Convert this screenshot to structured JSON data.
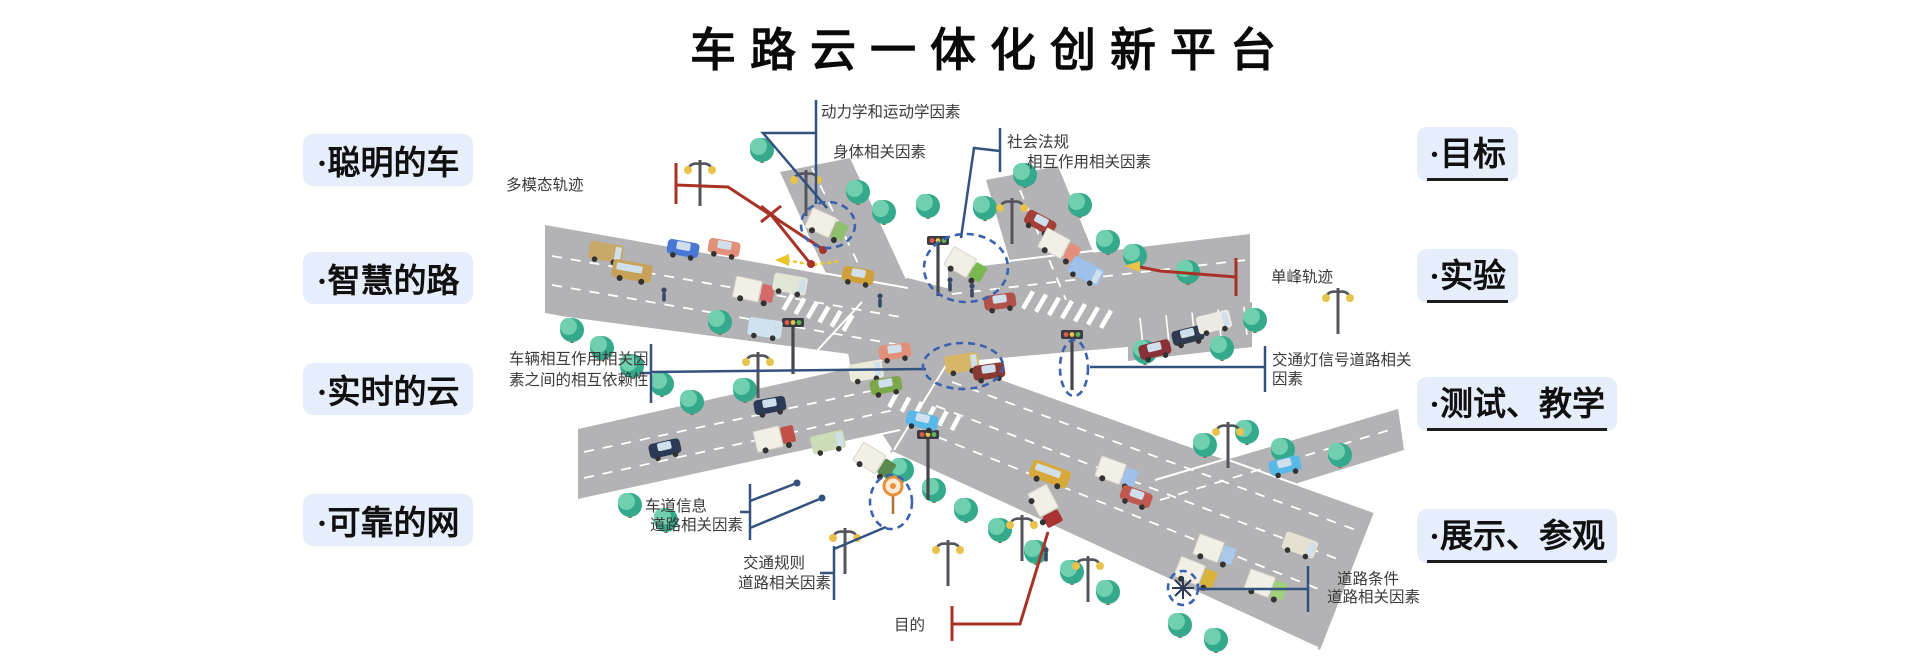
{
  "title": {
    "text": "车路云一体化创新平台"
  },
  "left_labels": [
    {
      "text": "·聪明的车"
    },
    {
      "text": "·智慧的路"
    },
    {
      "text": "·实时的云"
    },
    {
      "text": "·可靠的网"
    }
  ],
  "right_labels": [
    {
      "text": "·目标"
    },
    {
      "text": "·实验"
    },
    {
      "text": "·测试、教学"
    },
    {
      "text": "·展示、参观"
    }
  ],
  "callouts": {
    "dynamics": "动力学和运动学因素",
    "body_factor": "身体相关因素",
    "social_1": "社会法规",
    "social_2": "相互作用相关因素",
    "multimodal": "多模态轨迹",
    "interaction_1": "车辆相互作用相关因",
    "interaction_2": "素之间的相互依赖性",
    "lane_1": "车道信息",
    "lane_2": "道路相关因素",
    "rules_1": "交通规则",
    "rules_2": "道路相关因素",
    "purpose": "目的",
    "unimodal": "单峰轨迹",
    "signal_1": "交通灯信号道路相关",
    "signal_2": "因素",
    "condition_1": "道路条件",
    "condition_2": "道路相关因素"
  },
  "colors": {
    "label_bg": "#e6eefb",
    "callout_blue": "#33527f",
    "callout_red": "#a93226",
    "road": "#b3b2b4",
    "tree_dark": "#35a98c",
    "tree_light": "#6fcfae",
    "trunk": "#8a6a4a",
    "lamp_yellow": "#e8c24a",
    "highlight_dash": "#3a62b0",
    "pole": "#54545c",
    "window": "#cfe0ec",
    "truck_box": "#f2efe6"
  },
  "scene": {
    "trees": [
      [
        762,
        150
      ],
      [
        858,
        192
      ],
      [
        884,
        212
      ],
      [
        928,
        206
      ],
      [
        985,
        208
      ],
      [
        1025,
        175
      ],
      [
        1080,
        205
      ],
      [
        1108,
        242
      ],
      [
        1135,
        256
      ],
      [
        1188,
        272
      ],
      [
        1255,
        320
      ],
      [
        1222,
        348
      ],
      [
        1145,
        352
      ],
      [
        572,
        330
      ],
      [
        602,
        348
      ],
      [
        632,
        366
      ],
      [
        662,
        384
      ],
      [
        692,
        402
      ],
      [
        720,
        322
      ],
      [
        745,
        390
      ],
      [
        630,
        505
      ],
      [
        666,
        520
      ],
      [
        902,
        470
      ],
      [
        934,
        490
      ],
      [
        966,
        510
      ],
      [
        1000,
        530
      ],
      [
        1036,
        552
      ],
      [
        1072,
        572
      ],
      [
        1108,
        592
      ],
      [
        1205,
        445
      ],
      [
        1247,
        432
      ],
      [
        1283,
        450
      ],
      [
        1340,
        455
      ],
      [
        1180,
        625
      ],
      [
        1216,
        640
      ]
    ],
    "lamps": [
      [
        700,
        160
      ],
      [
        806,
        170
      ],
      [
        1012,
        198
      ],
      [
        758,
        352
      ],
      [
        845,
        528
      ],
      [
        948,
        540
      ],
      [
        1022,
        515
      ],
      [
        1088,
        556
      ],
      [
        1228,
        422
      ],
      [
        1338,
        288
      ]
    ],
    "signals": [
      [
        793,
        330,
        48
      ],
      [
        938,
        248,
        52
      ],
      [
        1072,
        342,
        52
      ],
      [
        928,
        442,
        62
      ]
    ],
    "lollipop": [
      893,
      486
    ],
    "pedestrians": [
      [
        950,
        286
      ],
      [
        972,
        292
      ],
      [
        1046,
        556
      ],
      [
        664,
        296
      ],
      [
        880,
        302
      ]
    ],
    "highlights": [
      [
        828,
        225,
        27,
        23
      ],
      [
        966,
        268,
        42,
        34
      ],
      [
        963,
        366,
        40,
        23
      ],
      [
        1074,
        368,
        14,
        28
      ],
      [
        891,
        502,
        21,
        27
      ],
      [
        1183,
        588,
        15,
        17
      ]
    ],
    "star": [
      1183,
      588
    ],
    "cars": [
      [
        606,
        252,
        10,
        "van",
        "#c9a96a"
      ],
      [
        632,
        271,
        10,
        "bus",
        "#c9a25a"
      ],
      [
        683,
        249,
        10,
        "car",
        "#4a77d4"
      ],
      [
        724,
        248,
        10,
        "car",
        "#e2907a"
      ],
      [
        754,
        291,
        12,
        "truck",
        "#d56a6a"
      ],
      [
        790,
        284,
        10,
        "van",
        "#e2e6d6"
      ],
      [
        858,
        276,
        10,
        "car",
        "#cf9f3a"
      ],
      [
        827,
        226,
        24,
        "truck",
        "#8fbf6f"
      ],
      [
        1040,
        223,
        28,
        "car",
        "#a43f38"
      ],
      [
        1060,
        247,
        28,
        "truck",
        "#e2907a"
      ],
      [
        1086,
        271,
        28,
        "van",
        "#9fc0ea"
      ],
      [
        966,
        266,
        30,
        "truck",
        "#7ab84f"
      ],
      [
        1000,
        302,
        -8,
        "car",
        "#b0524a"
      ],
      [
        1155,
        350,
        -14,
        "car",
        "#8a3038"
      ],
      [
        1188,
        336,
        -14,
        "car",
        "#2e3a50"
      ],
      [
        1214,
        322,
        -14,
        "van",
        "#eceae2"
      ],
      [
        765,
        328,
        8,
        "van",
        "#cfe3ee"
      ],
      [
        770,
        406,
        -10,
        "car",
        "#2c3a55"
      ],
      [
        866,
        371,
        -10,
        "van",
        "#eceadb"
      ],
      [
        886,
        386,
        -10,
        "car",
        "#7aa84a"
      ],
      [
        895,
        352,
        -8,
        "car",
        "#e2907a"
      ],
      [
        922,
        421,
        14,
        "car",
        "#58b8e8"
      ],
      [
        962,
        363,
        -8,
        "van",
        "#d8b668"
      ],
      [
        989,
        372,
        -8,
        "car",
        "#8a3832"
      ],
      [
        875,
        462,
        32,
        "truck",
        "#5a8a50"
      ],
      [
        665,
        449,
        -13,
        "car",
        "#2c3a55"
      ],
      [
        775,
        438,
        -13,
        "truck",
        "#c05048"
      ],
      [
        828,
        442,
        -13,
        "van",
        "#cddcb8"
      ],
      [
        1050,
        474,
        20,
        "bus",
        "#d8a93a"
      ],
      [
        1117,
        473,
        20,
        "truck",
        "#9fc0ea"
      ],
      [
        1136,
        497,
        20,
        "car",
        "#c05a50"
      ],
      [
        1215,
        551,
        20,
        "truck",
        "#aac8e8"
      ],
      [
        1266,
        586,
        20,
        "truck",
        "#9fd07a"
      ],
      [
        1196,
        574,
        22,
        "truck",
        "#d8b23a"
      ],
      [
        1300,
        545,
        20,
        "van",
        "#e4e0d2"
      ],
      [
        1046,
        507,
        62,
        "truck",
        "#a93232"
      ],
      [
        1285,
        466,
        -14,
        "car",
        "#58b8e8"
      ]
    ]
  }
}
